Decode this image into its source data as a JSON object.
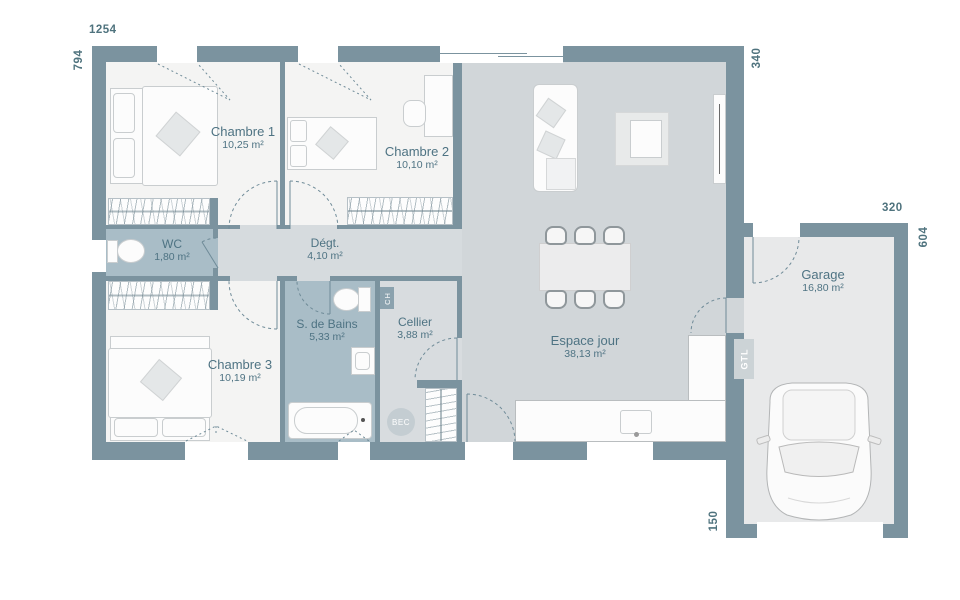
{
  "plan": {
    "dimensions": {
      "house_width": "1254",
      "house_height": "794",
      "right_top": "340",
      "garage_width": "320",
      "garage_height": "604",
      "garage_offset": "150"
    },
    "rooms": {
      "chambre1": {
        "name": "Chambre 1",
        "area": "10,25 m²"
      },
      "chambre2": {
        "name": "Chambre 2",
        "area": "10,10 m²"
      },
      "wc": {
        "name": "WC",
        "area": "1,80 m²"
      },
      "degagement": {
        "name": "Dégt.",
        "area": "4,10 m²"
      },
      "chambre3": {
        "name": "Chambre 3",
        "area": "10,19 m²"
      },
      "salle_de_bains": {
        "name": "S. de Bains",
        "area": "5,33 m²"
      },
      "cellier": {
        "name": "Cellier",
        "area": "3,88 m²"
      },
      "espace_jour": {
        "name": "Espace jour",
        "area": "38,13 m²"
      },
      "garage": {
        "name": "Garage",
        "area": "16,80 m²"
      }
    },
    "annotations": {
      "gtl": "GTL",
      "bec": "BEC",
      "chaudiere": "CH"
    },
    "colors": {
      "wall": "#7b939f",
      "floor_room": "#f4f4f3",
      "floor_day": "#d1d6d9",
      "floor_wet": "#a9bdc7",
      "floor_hall": "#d6dbde",
      "floor_garage": "#e8e9ea",
      "label_text": "#4e7383",
      "dim_text": "#4f737e"
    }
  }
}
